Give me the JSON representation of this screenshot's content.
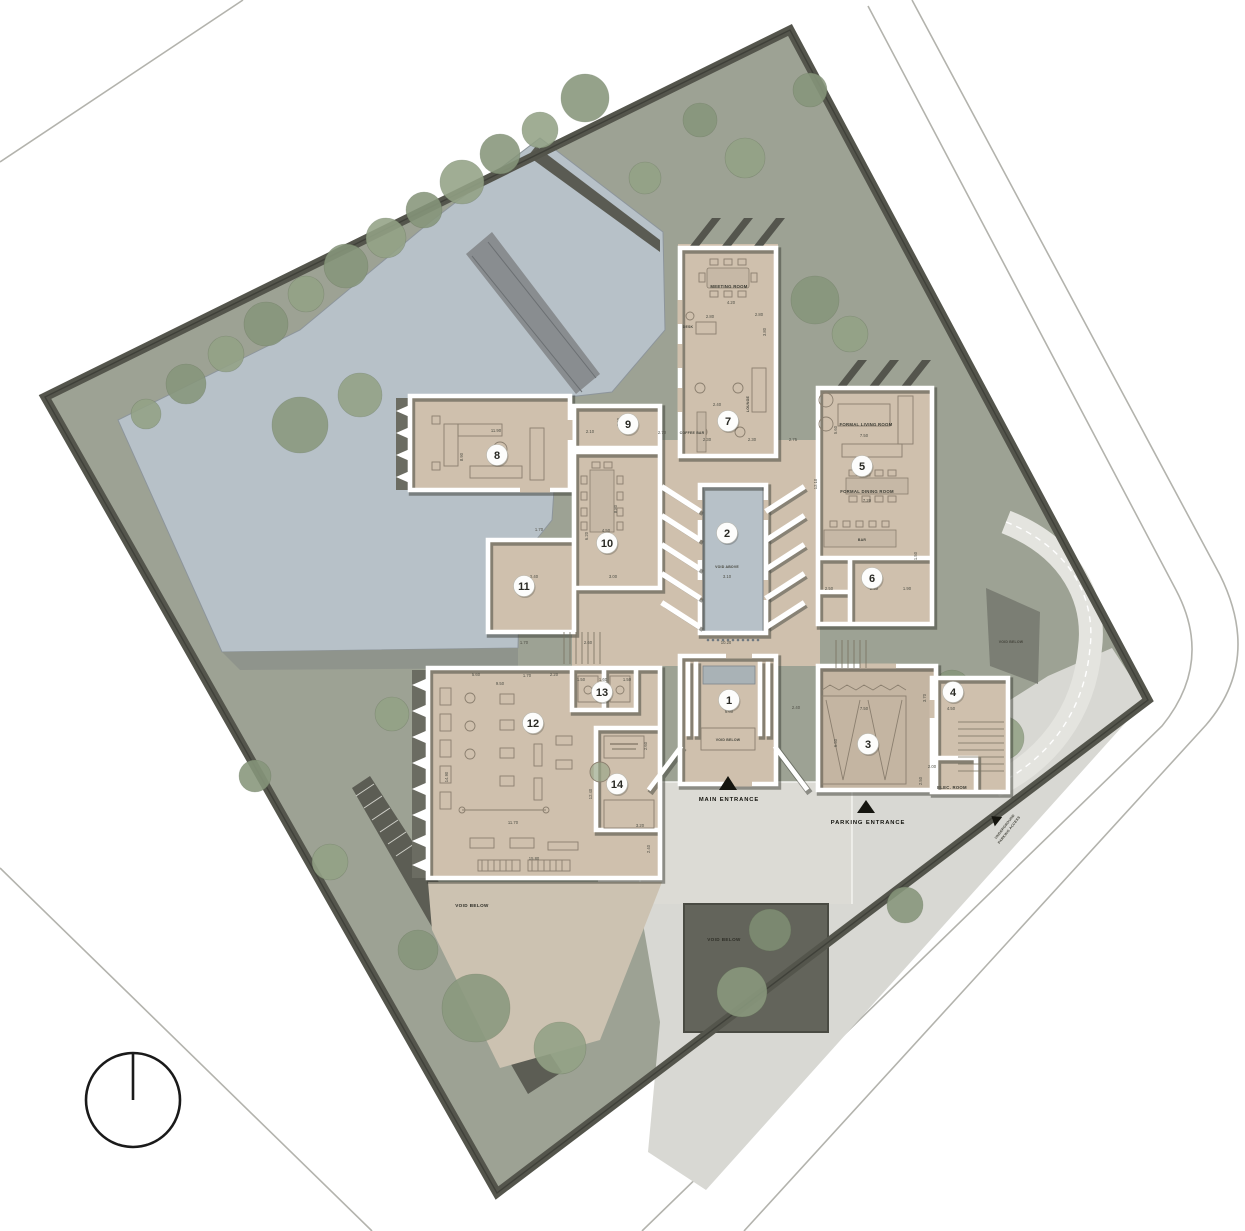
{
  "labels": {
    "meeting_room": "MEETING ROOM",
    "desk": "DESK",
    "lounge": "LOUNGE",
    "coffee_bar": "COFFEE BAR",
    "formal_living_room": "FORMAL LIVING ROOM",
    "formal_dining_room": "FORMAL DINING ROOM",
    "bar": "BAR",
    "void_above": "VOID ABOVE",
    "void_below_entry": "VOID BELOW",
    "void_below_terrace": "VOID BELOW",
    "void_below_garden": "VOID BELOW",
    "void_below_ramp": "VOID BELOW",
    "main_entrance": "MAIN ENTRANCE",
    "parking_entrance": "PARKING ENTRANCE",
    "elec_room": "ELEC. ROOM",
    "underground_parking_line1": "UNDERGROUND",
    "underground_parking_line2": "PARKING ACCESS"
  },
  "room_markers": [
    {
      "number": "1",
      "x": 729,
      "y": 700
    },
    {
      "number": "2",
      "x": 727,
      "y": 533
    },
    {
      "number": "3",
      "x": 868,
      "y": 744
    },
    {
      "number": "4",
      "x": 953,
      "y": 692
    },
    {
      "number": "5",
      "x": 862,
      "y": 466
    },
    {
      "number": "6",
      "x": 872,
      "y": 578
    },
    {
      "number": "7",
      "x": 728,
      "y": 421
    },
    {
      "number": "8",
      "x": 497,
      "y": 455
    },
    {
      "number": "9",
      "x": 628,
      "y": 424
    },
    {
      "number": "10",
      "x": 607,
      "y": 543
    },
    {
      "number": "11",
      "x": 524,
      "y": 586
    },
    {
      "number": "12",
      "x": 533,
      "y": 723
    },
    {
      "number": "13",
      "x": 602,
      "y": 692
    },
    {
      "number": "14",
      "x": 617,
      "y": 784
    }
  ],
  "dimensions": [
    {
      "t": "4.20",
      "x": 731,
      "y": 304
    },
    {
      "t": "2.80",
      "x": 710,
      "y": 318
    },
    {
      "t": "2.80",
      "x": 759,
      "y": 316
    },
    {
      "t": "3.80",
      "x": 766,
      "y": 332,
      "r": -90
    },
    {
      "t": "2.40",
      "x": 717,
      "y": 406
    },
    {
      "t": "2.30",
      "x": 707,
      "y": 441
    },
    {
      "t": "2.30",
      "x": 752,
      "y": 441
    },
    {
      "t": "2.70",
      "x": 662,
      "y": 434
    },
    {
      "t": "2.75",
      "x": 793,
      "y": 441
    },
    {
      "t": "2.10",
      "x": 590,
      "y": 433
    },
    {
      "t": "2.60",
      "x": 626,
      "y": 432
    },
    {
      "t": "2.40",
      "x": 620,
      "y": 422,
      "r": -90
    },
    {
      "t": "11.90",
      "x": 496,
      "y": 432
    },
    {
      "t": "8.90",
      "x": 463,
      "y": 457,
      "r": -90
    },
    {
      "t": "7.50",
      "x": 864,
      "y": 437
    },
    {
      "t": "5.60",
      "x": 837,
      "y": 430,
      "r": -90
    },
    {
      "t": "7.20",
      "x": 867,
      "y": 502
    },
    {
      "t": "12.10",
      "x": 817,
      "y": 484,
      "r": -90
    },
    {
      "t": "1.70",
      "x": 539,
      "y": 531
    },
    {
      "t": "4.50",
      "x": 606,
      "y": 532
    },
    {
      "t": "6.20",
      "x": 588,
      "y": 536,
      "r": -90
    },
    {
      "t": "8.80",
      "x": 617,
      "y": 509,
      "r": -90
    },
    {
      "t": "3.10",
      "x": 727,
      "y": 578
    },
    {
      "t": "10.20",
      "x": 726,
      "y": 644
    },
    {
      "t": "2.50",
      "x": 829,
      "y": 590
    },
    {
      "t": "2.90",
      "x": 874,
      "y": 590
    },
    {
      "t": "1.90",
      "x": 907,
      "y": 590
    },
    {
      "t": "1.50",
      "x": 917,
      "y": 556,
      "r": -90
    },
    {
      "t": "2.40",
      "x": 534,
      "y": 578
    },
    {
      "t": "3.00",
      "x": 613,
      "y": 578
    },
    {
      "t": "1.70",
      "x": 524,
      "y": 644
    },
    {
      "t": "2.60",
      "x": 588,
      "y": 644
    },
    {
      "t": "6.60",
      "x": 729,
      "y": 713
    },
    {
      "t": "2.40",
      "x": 796,
      "y": 709
    },
    {
      "t": "7.50",
      "x": 864,
      "y": 710
    },
    {
      "t": "6.50",
      "x": 837,
      "y": 743,
      "r": -90
    },
    {
      "t": "4.50",
      "x": 951,
      "y": 710
    },
    {
      "t": "3.70",
      "x": 926,
      "y": 698,
      "r": -90
    },
    {
      "t": "2.00",
      "x": 932,
      "y": 768
    },
    {
      "t": "2.50",
      "x": 922,
      "y": 781,
      "r": -90
    },
    {
      "t": "5.60",
      "x": 476,
      "y": 676
    },
    {
      "t": "1.70",
      "x": 527,
      "y": 677
    },
    {
      "t": "2.20",
      "x": 554,
      "y": 676
    },
    {
      "t": "1.50",
      "x": 581,
      "y": 681
    },
    {
      "t": "1.60",
      "x": 603,
      "y": 681
    },
    {
      "t": "1.50",
      "x": 627,
      "y": 681
    },
    {
      "t": "9.50",
      "x": 500,
      "y": 685
    },
    {
      "t": "14.90",
      "x": 448,
      "y": 777,
      "r": -90
    },
    {
      "t": "12.40",
      "x": 592,
      "y": 794,
      "r": -90
    },
    {
      "t": "11.70",
      "x": 513,
      "y": 824
    },
    {
      "t": "15.80",
      "x": 534,
      "y": 860
    },
    {
      "t": "3.20",
      "x": 640,
      "y": 827
    },
    {
      "t": "2.40",
      "x": 650,
      "y": 849,
      "r": -90
    },
    {
      "t": "2.60",
      "x": 647,
      "y": 746,
      "r": -90
    }
  ],
  "colors": {
    "floor_tan": "#cfc0ad",
    "garage_tan": "#c4b5a2",
    "water": "#b7c1c8",
    "landscape": "#9da294",
    "hedge_dark": "#54554c",
    "paving": "#d8d8d3",
    "sunken": "#63645b",
    "wall_white": "#ffffff",
    "shadow": "#3c3d35"
  }
}
